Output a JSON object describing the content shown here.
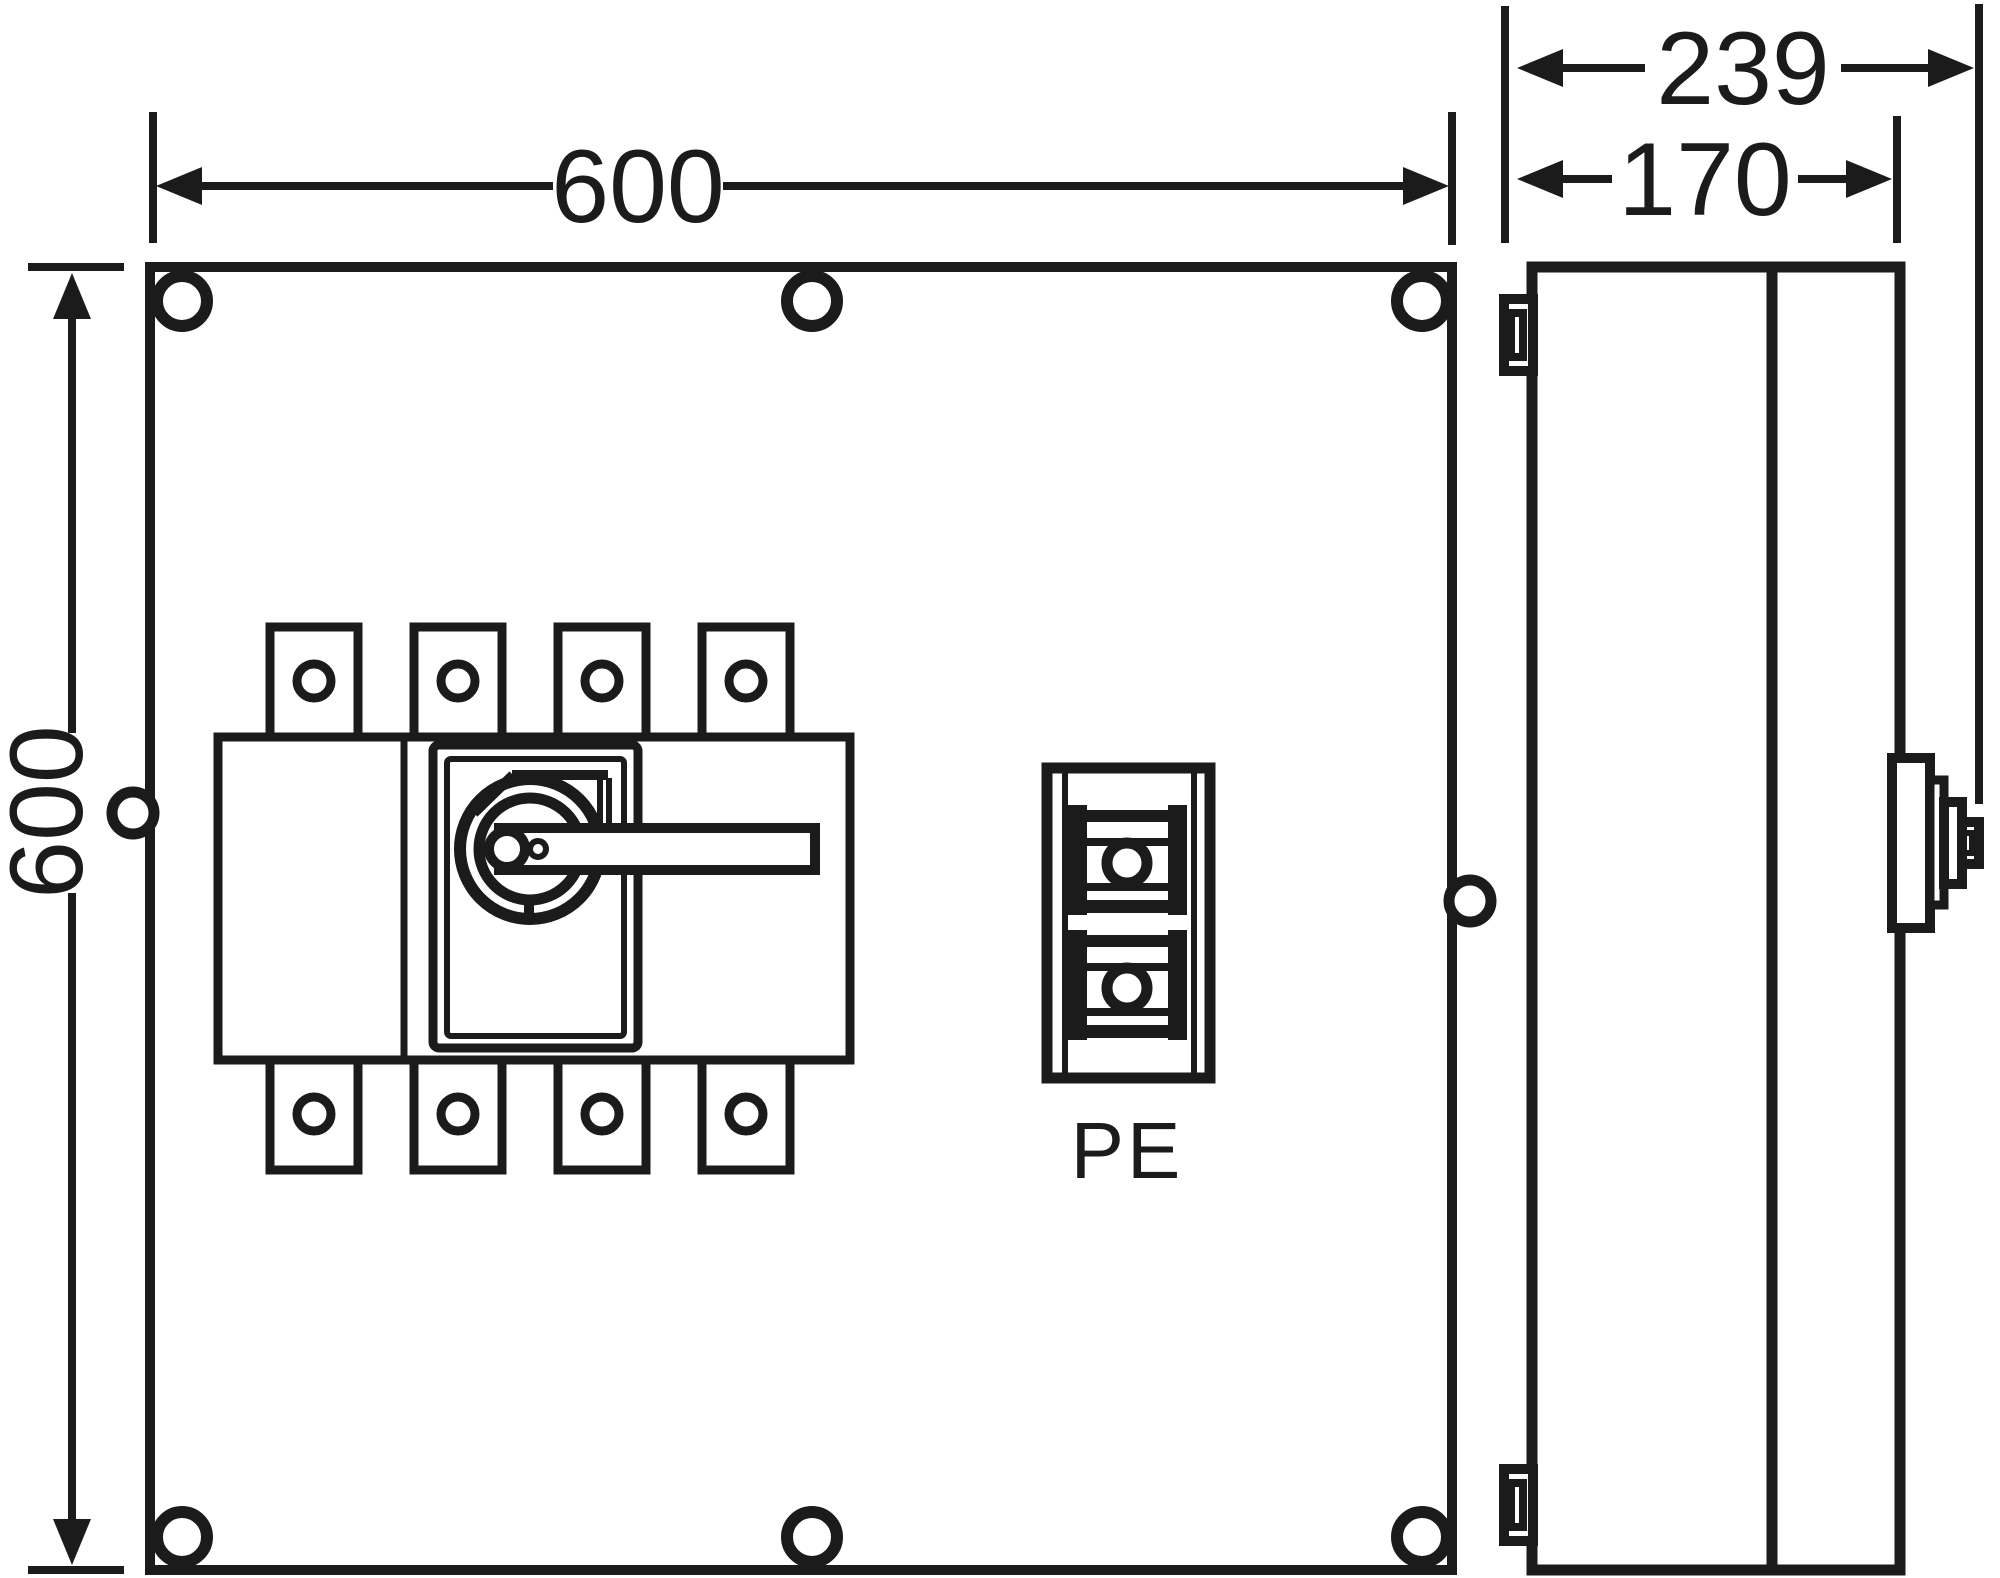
{
  "drawing": {
    "type": "enclosure-dimension-drawing",
    "views": [
      "front",
      "side"
    ]
  },
  "dimensions": {
    "front_width": "600",
    "front_height": "600",
    "side_depth_total": "239",
    "side_depth_body": "170"
  },
  "labels": {
    "pe_terminal": "PE"
  },
  "colors": {
    "line": "#1b1b1b",
    "background": "#ffffff"
  }
}
